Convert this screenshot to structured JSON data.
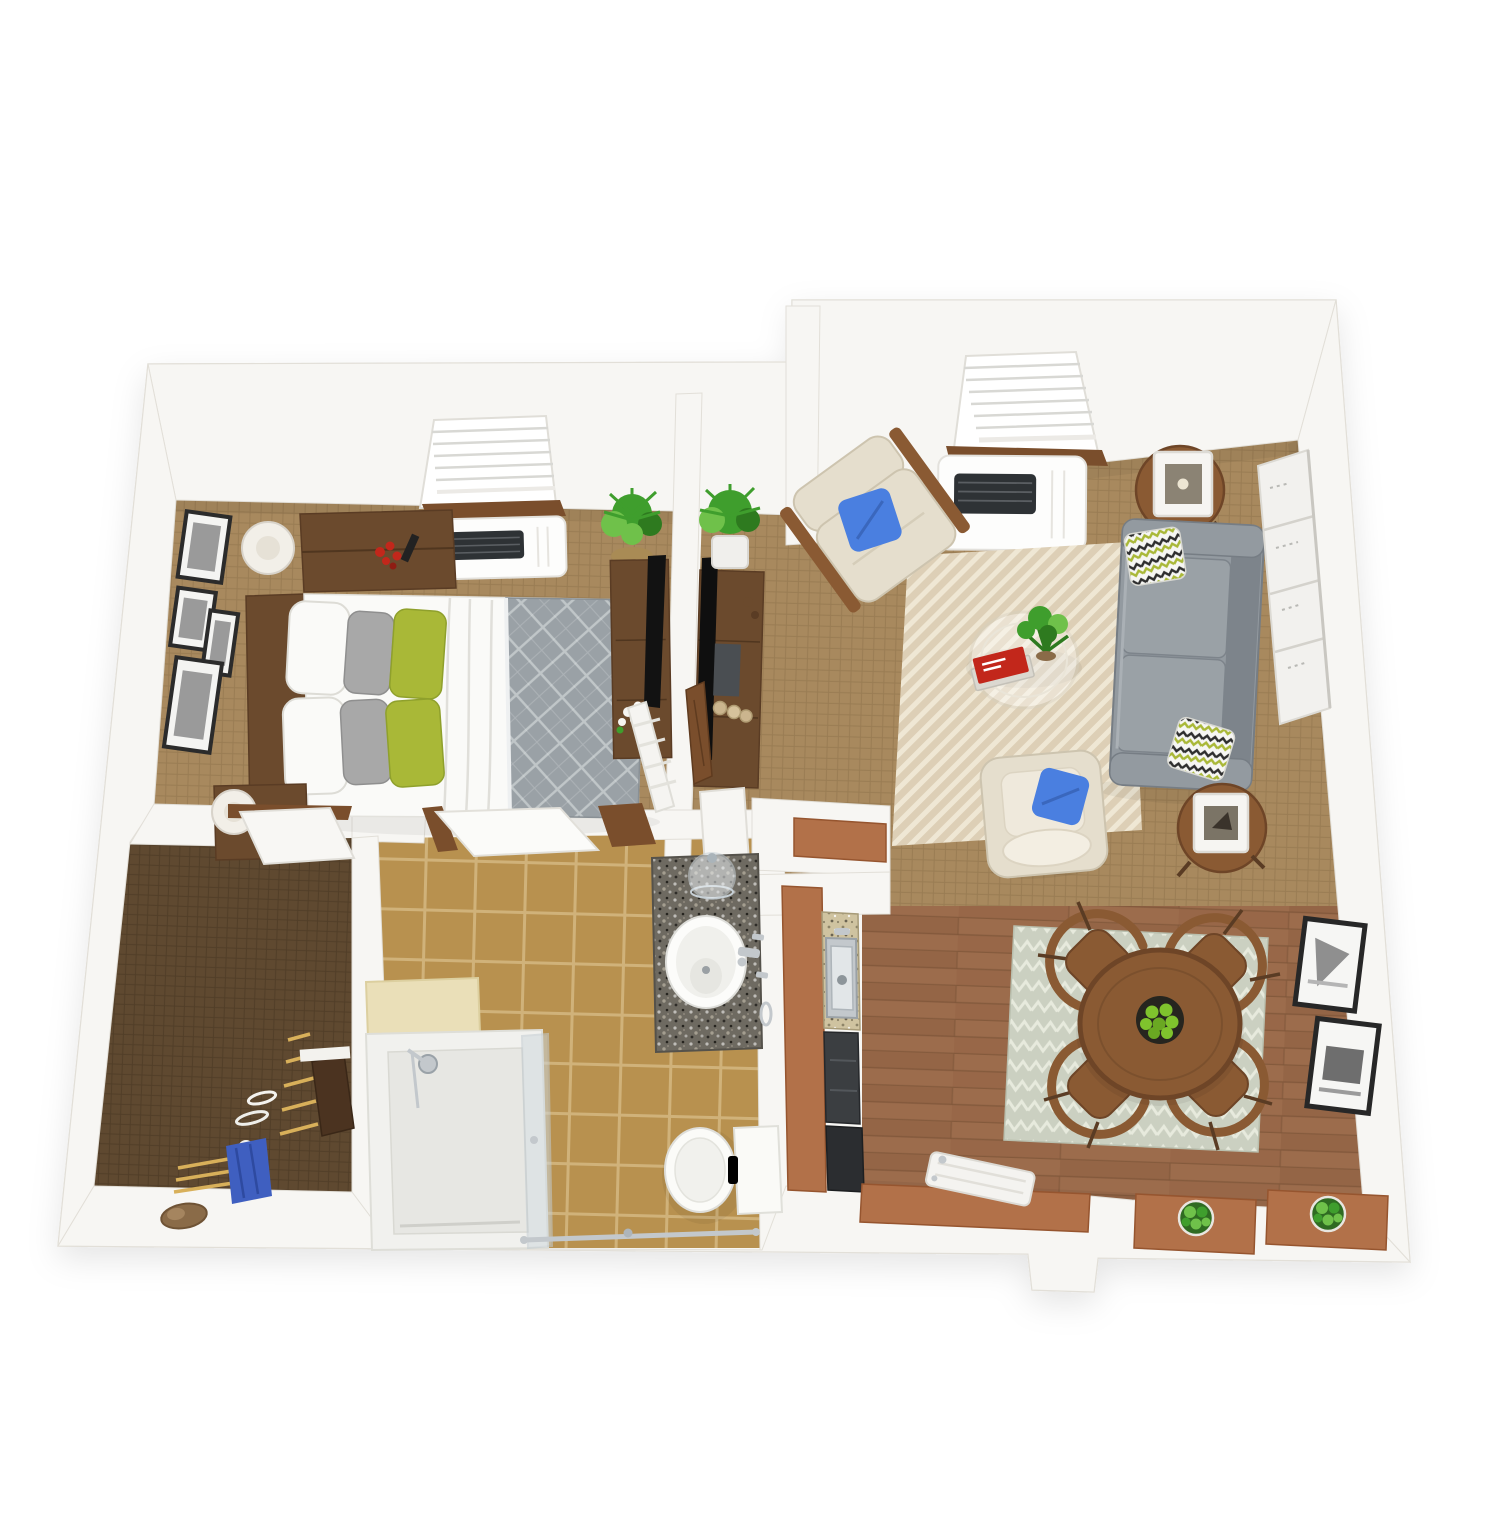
{
  "meta": {
    "title": "3D top-view floor plan render of a one-bedroom apartment",
    "canvas": {
      "width": 1500,
      "height": 1536
    },
    "style": "photoreal dollhouse render, no text labels"
  },
  "colors": {
    "wall": "#f7f6f3",
    "wall_edge": "#e2dfd8",
    "carpet": "#a8895e",
    "carpet_line": "#93764e",
    "closet_floor": "#5f4930",
    "closet_floor_line": "#4d3a25",
    "tile": "#b8914f",
    "tile_grout": "#d3b67e",
    "wood_floor": "#9c6c4c",
    "wood_line": "#7f5639",
    "wood_plank_dark": "#8e5f41",
    "rug_living": "#ddcfb6",
    "rug_living_line": "#f1e8d6",
    "rug_dining": "#cbd0c1",
    "rug_dining_line": "#e7eadd",
    "sofa": "#939aa0",
    "sofa_dark": "#7d848b",
    "armchair": "#e5decd",
    "armchair_shade": "#cdc4af",
    "pillow_blue": "#4a7fe0",
    "pillow_green": "#a9b837",
    "pillow_green_dark": "#8fa02c",
    "gray_pillow": "#a8a8a8",
    "white_fabric": "#fafaf8",
    "duvet": "#9aa1a6",
    "duvet_line": "#c5cacc",
    "wood_dark": "#6b4a2d",
    "wood_mid": "#8a5a33",
    "wood_deep": "#5a3c24",
    "door_wood": "#7a4e2c",
    "terracotta": "#b27149",
    "terracotta_dark": "#96552f",
    "granite_dark": "#6e6a61",
    "granite_light": "#cfc3a0",
    "steel": "#c3c8cc",
    "appliance": "#3b3e41",
    "appliance_deep": "#2b2d30",
    "plant": "#3f9e2d",
    "plant_light": "#6fc14a",
    "plant_deep": "#2e7a1f",
    "apples": "#7fc32d",
    "frame": "#2c2c2c",
    "photo_gray": "#9a9a9a",
    "lamp": "#f2efe8",
    "red_accent": "#c2271b",
    "blue_cloth": "#3f5fc0",
    "hanger": "#d8b05a",
    "glass": "#cfd8dd",
    "ac_grille": "#2e3235"
  },
  "scene": {
    "view": "top-down 3d dollhouse",
    "rooms": [
      {
        "id": "bedroom",
        "furniture": [
          "platform-bed",
          "gray-quilted-duvet",
          "white-pillows",
          "gray-pillows",
          "green-accent-pillows",
          "nightstand-north",
          "nightstand-south",
          "white-table-lamps",
          "gallery-wall-frames",
          "window-with-blinds",
          "wall-ac-unit",
          "floor-plant",
          "media-console",
          "flat-tv",
          "white-ladder-rack",
          "white-flowers"
        ]
      },
      {
        "id": "entry-hall",
        "furniture": [
          "console-table",
          "flat-tv",
          "potted-plant",
          "leaning-wood-door",
          "decor-balls",
          "white-door-panel"
        ]
      },
      {
        "id": "living-room",
        "furniture": [
          "window-with-blinds",
          "wall-ac-unit",
          "beige-armchair",
          "blue-throw-pillow",
          "gray-sofa",
          "chevron-throw-pillows",
          "round-side-table-north",
          "cube-lantern",
          "round-side-table-south",
          "cube-vase",
          "glass-coffee-table",
          "table-plant",
          "red-book",
          "herringbone-rug",
          "cream-accent-chair",
          "leaning-wall-panel"
        ]
      },
      {
        "id": "closet",
        "furniture": [
          "wood-hangers",
          "blue-garment",
          "white-hangers",
          "leaning-closet-door",
          "shoe"
        ]
      },
      {
        "id": "bathroom",
        "furniture": [
          "granite-vanity",
          "round-sink",
          "chrome-faucet",
          "glass-cloche",
          "towel-ring",
          "toilet",
          "walk-in-shower",
          "shower-glass-panel",
          "shower-head",
          "grab-bar",
          "cream-half-wall",
          "open-door-panel"
        ]
      },
      {
        "id": "kitchen",
        "furniture": [
          "pass-through-ledge",
          "terracotta-counter",
          "granite-counter-strip",
          "stainless-sink",
          "dark-appliances"
        ]
      },
      {
        "id": "dining-area",
        "furniture": [
          "patterned-rug",
          "round-dining-table",
          "fruit-bowl-green-apples",
          "bentwood-chair-nw",
          "bentwood-chair-ne",
          "bentwood-chair-sw",
          "bentwood-chair-se",
          "framed-art-upper",
          "framed-art-lower",
          "terracotta-ledge",
          "planter-table-west",
          "planter-table-east",
          "white-folding-table"
        ]
      }
    ]
  }
}
